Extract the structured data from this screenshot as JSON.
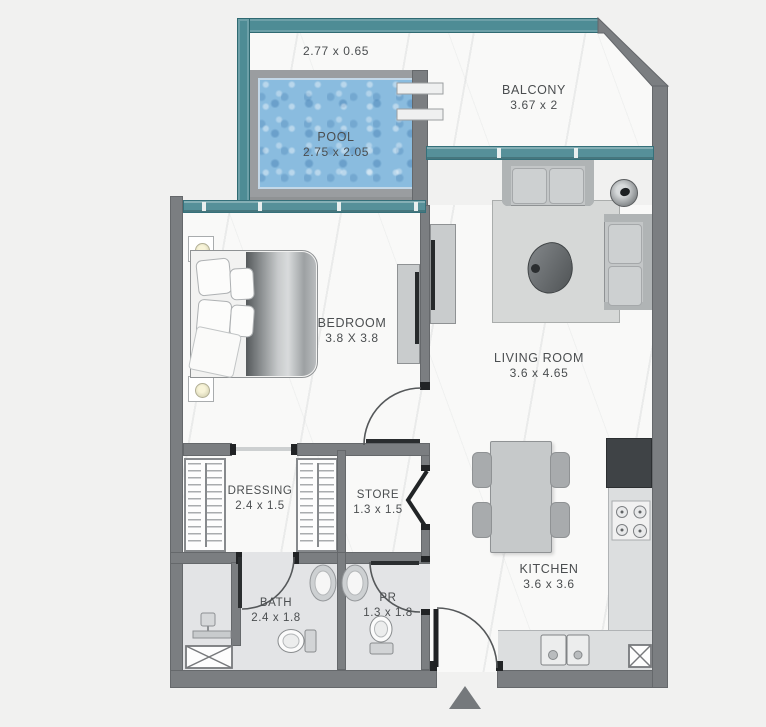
{
  "floorplan": {
    "deck_dim": "2.77 x 0.65",
    "rooms": {
      "pool": {
        "name": "POOL",
        "dims": "2.75 x 2.05"
      },
      "balcony": {
        "name": "BALCONY",
        "dims": "3.67 x 2"
      },
      "bedroom": {
        "name": "BEDROOM",
        "dims": "3.8 X 3.8"
      },
      "living_room": {
        "name": "LIVING ROOM",
        "dims": "3.6 x  4.65"
      },
      "dressing": {
        "name": "DRESSING",
        "dims": "2.4 x 1.5"
      },
      "store": {
        "name": "STORE",
        "dims": "1.3 x 1.5"
      },
      "bath": {
        "name": "BATH",
        "dims": "2.4 x 1.8"
      },
      "powder_room": {
        "name": "PR",
        "dims": "1.3 x 1.8"
      },
      "kitchen": {
        "name": "KITCHEN",
        "dims": "3.6 x  3.6"
      }
    },
    "colors": {
      "wall_gray": "#7b7e81",
      "glass_teal": "#4e8c95",
      "pool_water": "#8abcdf",
      "floor_white": "#f9f9f8",
      "wet_floor": "#e3e4e6",
      "label_text": "#4b4e50"
    }
  }
}
